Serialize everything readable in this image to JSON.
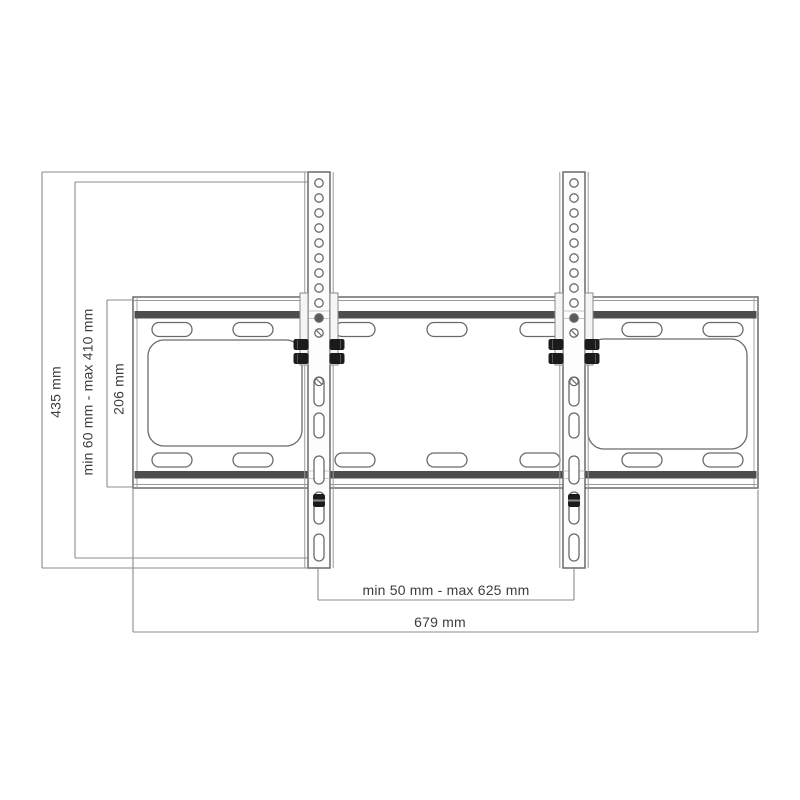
{
  "figure": {
    "kind": "technical-dimension-drawing",
    "subject": "tilting TV wall mount bracket (wall plate with two vertical rails)",
    "background_color": "#ffffff",
    "outline_color": "#6a6a6a",
    "light_line_color": "#9a9a9a",
    "dim_line_color": "#8c8c8c",
    "band_color": "#4d4d4d",
    "hardware_color": "#1b1b1b",
    "text_color": "#3d3d3d"
  },
  "dimensions": {
    "total_height": "435 mm",
    "hole_pattern_height_range": "min 60 mm - max 410 mm",
    "plate_height": "206 mm",
    "hole_pattern_width_range": "min 50 mm - max 625 mm",
    "total_width": "679 mm"
  },
  "geometry": {
    "plate": {
      "x": 133,
      "y": 297,
      "w": 625,
      "h": 191,
      "inner_inset": 4
    },
    "bands": {
      "x": 134.5,
      "w": 622,
      "ys": [
        311,
        471
      ],
      "h": 7.5
    },
    "plate_slots": {
      "xs": [
        152,
        233,
        335,
        427,
        520,
        622,
        703
      ],
      "w": 40,
      "h": 14,
      "rx": 7,
      "top_y": 322.5,
      "bottom_y": 453
    },
    "emboss_panels": [
      {
        "x": 148,
        "y": 340,
        "w": 154,
        "h": 106
      },
      {
        "x": 588,
        "y": 339,
        "w": 159,
        "h": 110
      }
    ],
    "emboss_rx": 16,
    "rails": {
      "centers": [
        319,
        574
      ],
      "top": 172,
      "bottom": 568,
      "w": 22,
      "flange_dx": 14.2,
      "holes": {
        "start_y": 183,
        "step": 15,
        "count": 11,
        "r": 4.2,
        "dark_index": 9,
        "slash_index": 10
      },
      "tabs": {
        "y": 293,
        "h": 72,
        "w": 8,
        "dx": 19
      },
      "bolts": {
        "ys": [
          339,
          353
        ],
        "w": 15,
        "h": 11,
        "rx": 2.2,
        "out_dx": 25.5,
        "in_dx": 10.5
      },
      "slots": [
        {
          "y": 377,
          "h": 29
        },
        {
          "y": 413,
          "h": 25
        },
        {
          "y": 456,
          "h": 28
        },
        {
          "y": 492,
          "h": 32
        },
        {
          "y": 534,
          "h": 27
        }
      ],
      "slot_w": 10,
      "slot_screw_circle_y": 381.5,
      "lock_screw": {
        "y": 494,
        "w": 12,
        "h": 13
      }
    },
    "dims": {
      "total_height": {
        "x": 42,
        "y1": 172,
        "y2": 568,
        "cap_to": 308
      },
      "hole_height_range": {
        "x": 75,
        "y1": 182,
        "y2": 558,
        "cap_to": 308
      },
      "plate_height": {
        "x": 107,
        "y1": 300,
        "y2": 487,
        "cap_to": 133
      },
      "hole_width_range": {
        "y": 600,
        "x1": 318,
        "x2": 574,
        "ext_top": 568
      },
      "total_width": {
        "y": 632,
        "x1": 133,
        "x2": 758,
        "ext_top_l": 488,
        "ext_top_r": 490
      }
    }
  }
}
